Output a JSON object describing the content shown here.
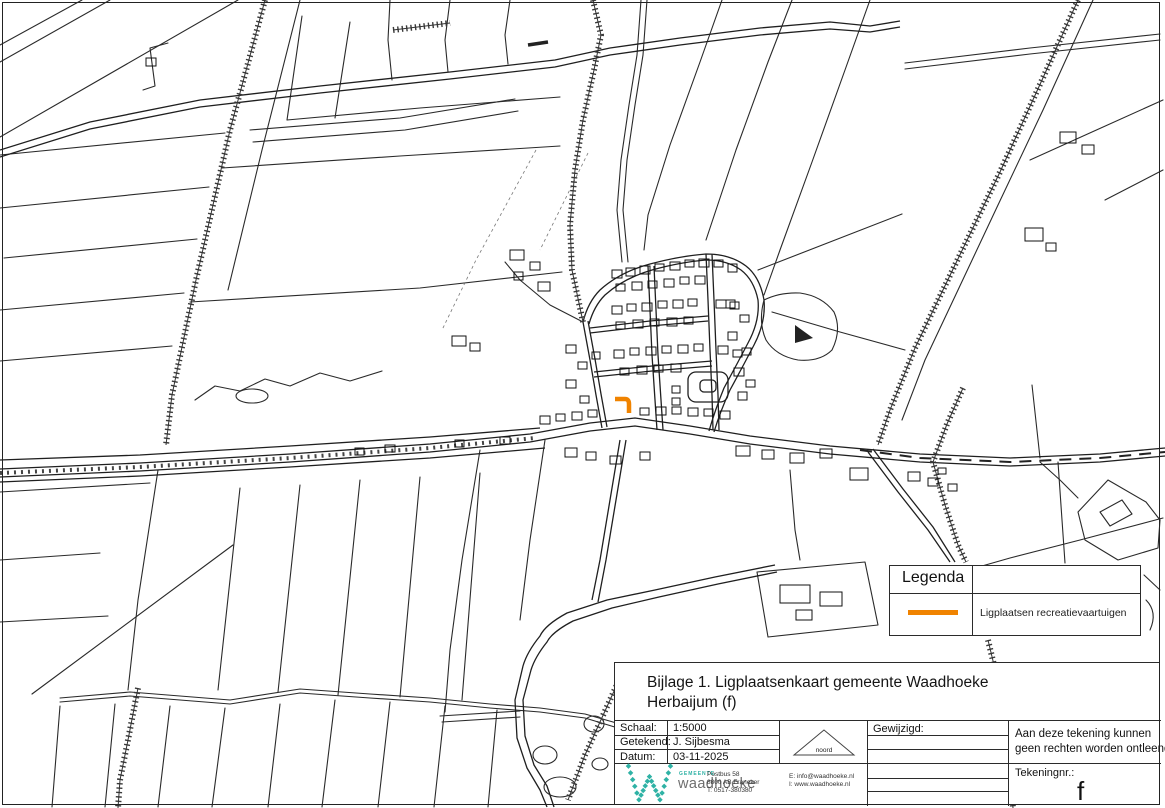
{
  "colors": {
    "accent_orange": "#F08300",
    "logo_teal": "#2FB2A5",
    "line": "#2a2a2a"
  },
  "title_block": {
    "title_line1": "Bijlage 1. Ligplaatsenkaart gemeente Waadhoeke",
    "title_line2": "Herbaijum (f)",
    "schaal_label": "Schaal:",
    "schaal_value": "1:5000",
    "getekend_label": "Getekend:",
    "getekend_value": "J. Sijbesma",
    "datum_label": "Datum:",
    "datum_value": "03-11-2025",
    "gewijzigd_label": "Gewijzigd:",
    "north_label": "noord",
    "disclaimer_line1": "Aan deze tekening kunnen",
    "disclaimer_line2": "geen rechten worden ontleend",
    "tekeningnr_label": "Tekeningnr.:",
    "tekeningnr_value": "f"
  },
  "logo": {
    "gemeente": "GEMEENTE",
    "name": "waadhoeke"
  },
  "contact": {
    "line1": "Postbus 58",
    "line2": "8800 AB Franeker",
    "line3": "T: 0517-380380",
    "email": "E: info@waadhoeke.nl",
    "web": "I: www.waadhoeke.nl"
  },
  "legend": {
    "header": "Legenda",
    "items": [
      {
        "label": "Ligplaatsen recreatievaartuigen",
        "color": "#F08300"
      }
    ]
  }
}
